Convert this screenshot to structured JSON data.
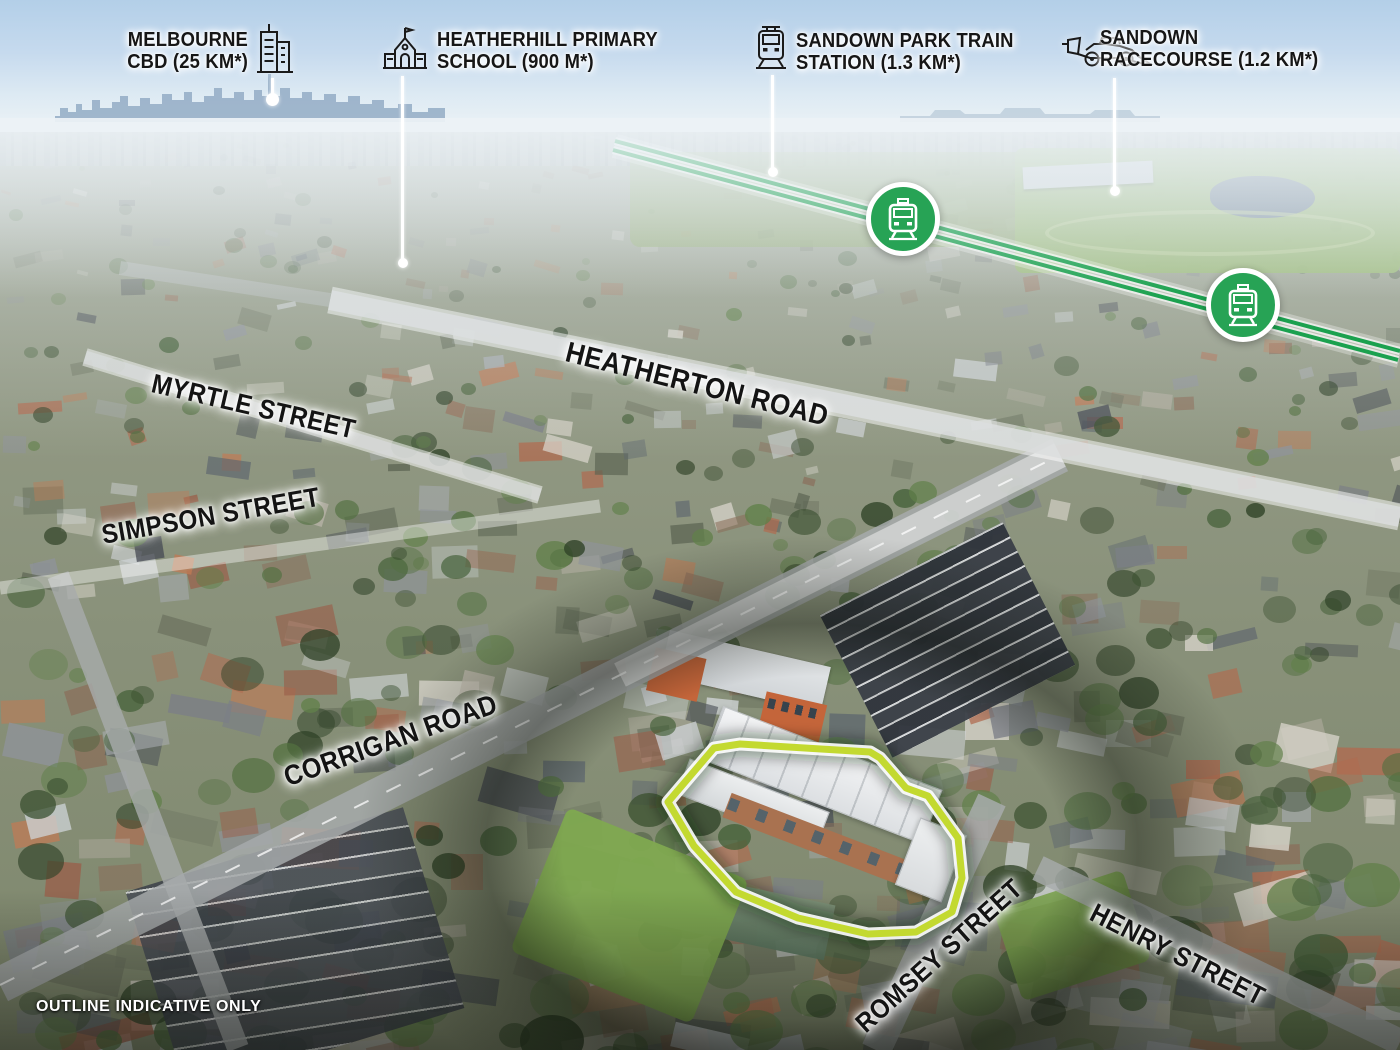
{
  "colors": {
    "outline_green": "#c3d930",
    "rail_green": "#1ba14f",
    "badge_green": "#27a355",
    "label_text": "#161616",
    "leader_white": "#ffffff",
    "watermark_white": "#ffffff"
  },
  "poi_labels": [
    {
      "id": "melbourne-cbd",
      "line1": "MELBOURNE",
      "line2": "CBD (25 KM*)",
      "icon": "city-buildings-icon"
    },
    {
      "id": "heatherhill-primary-school",
      "line1": "HEATHERHILL PRIMARY",
      "line2": "SCHOOL (900 M*)",
      "icon": "school-icon"
    },
    {
      "id": "sandown-park-train-station",
      "line1": "SANDOWN PARK TRAIN",
      "line2": "STATION (1.3 KM*)",
      "icon": "train-icon"
    },
    {
      "id": "sandown-racecourse",
      "line1": "SANDOWN",
      "line2": "RACECOURSE (1.2 KM*)",
      "icon": "race-car-icon"
    }
  ],
  "street_labels": [
    {
      "name": "MYRTLE STREET"
    },
    {
      "name": "HEATHERTON ROAD"
    },
    {
      "name": "SIMPSON STREET"
    },
    {
      "name": "CORRIGAN ROAD"
    },
    {
      "name": "ROMSEY STREET"
    },
    {
      "name": "HENRY STREET"
    }
  ],
  "transit": {
    "badge_icon": "train-icon",
    "badge_count": 2
  },
  "watermark": "OUTLINE INDICATIVE ONLY"
}
